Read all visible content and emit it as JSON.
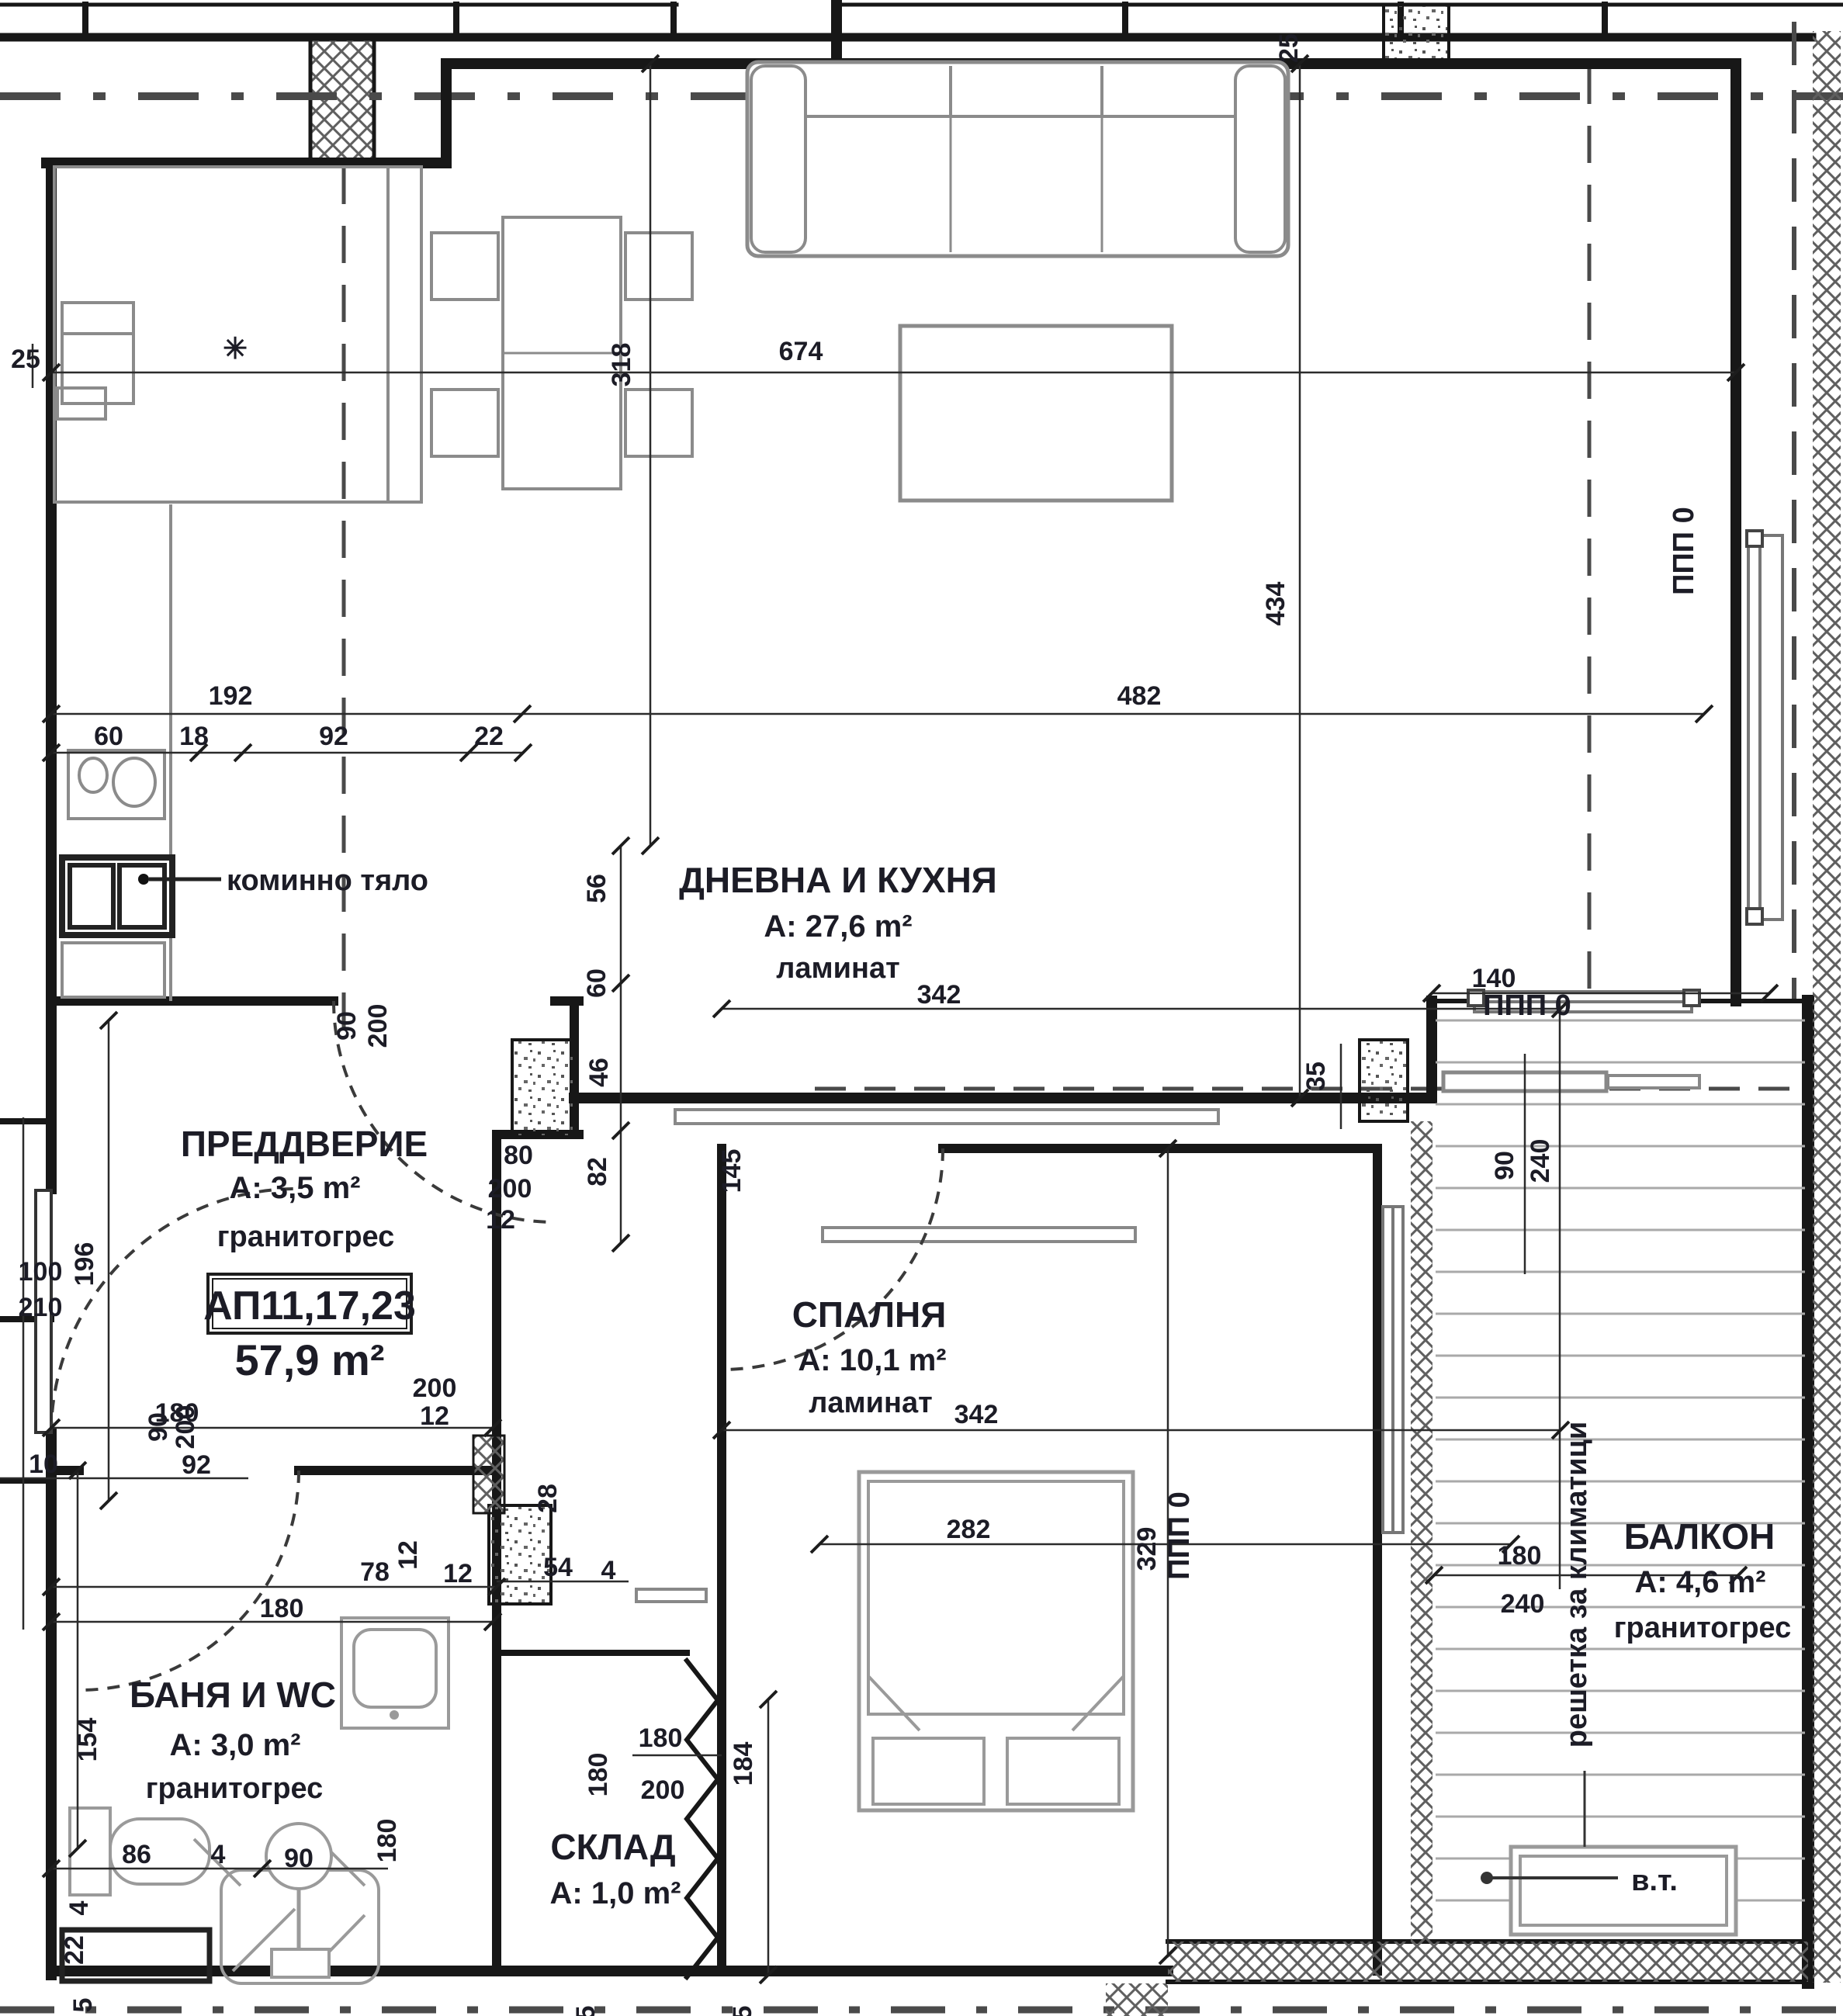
{
  "apartment": {
    "number": "АП11,17,23",
    "total_area": "57,9 m²"
  },
  "rooms": {
    "living": {
      "name": "ДНЕВНА И КУХНЯ",
      "area": "A: 27,6 m²",
      "floor": "ламинат"
    },
    "hall": {
      "name": "ПРЕДДВЕРИЕ",
      "area": "A: 3,5 m²",
      "floor": "гранитогрес"
    },
    "bedroom": {
      "name": "СПАЛНЯ",
      "area": "A: 10,1 m²",
      "floor": "ламинат"
    },
    "bath": {
      "name": "БАНЯ И WC",
      "area": "A: 3,0 m²",
      "floor": "гранитогрес"
    },
    "storage": {
      "name": "СКЛАД",
      "area": "A: 1,0 m²"
    },
    "balcony": {
      "name": "БАЛКОН",
      "area": "A: 4,6 m²",
      "floor": "гранитогрес"
    }
  },
  "annotations": {
    "chimney": "коминно тяло",
    "ac_grille": "решетка за климатици",
    "water_point": "в.т.",
    "window_mark_right": "ППП 0",
    "window_mark_living": "ППП 0",
    "window_mark_bedroom": "ППП 0",
    "asterisk": "✳"
  },
  "dims": {
    "top_25": "25",
    "left_25": "25",
    "v318": "318",
    "h674": "674",
    "v434": "434",
    "w192": "192",
    "w482": "482",
    "k60": "60",
    "k18": "18",
    "k92": "92",
    "k22": "22",
    "v56": "56",
    "v60": "60",
    "v46": "46",
    "v82": "82",
    "door80": "80",
    "door200": "200",
    "door12": "12",
    "pd90": "90",
    "pd200": "200",
    "l342": "342",
    "w140": "140",
    "v35": "35",
    "v90r": "90",
    "v240r": "240",
    "v196": "196",
    "e100": "100",
    "e210": "210",
    "bd145": "145",
    "h180a": "180",
    "s200": "200",
    "s12": "12",
    "s12r": "12",
    "bth90": "90",
    "bth200": "200",
    "t10": "10",
    "t92": "92",
    "b78": "78",
    "b12": "12",
    "b28": "28",
    "b54": "54",
    "b4": "4",
    "b180": "180",
    "v154": "154",
    "s86": "86",
    "s4": "4",
    "shower90": "90",
    "v180b": "180",
    "v4": "4",
    "v22": "22",
    "v5": "5",
    "sk180v": "180",
    "sk180h": "180",
    "sk200": "200",
    "sk184": "184",
    "sp342": "342",
    "bed282": "282",
    "v329": "329",
    "bal180": "180",
    "bal240": "240",
    "f5a": "5",
    "f5b": "5"
  }
}
